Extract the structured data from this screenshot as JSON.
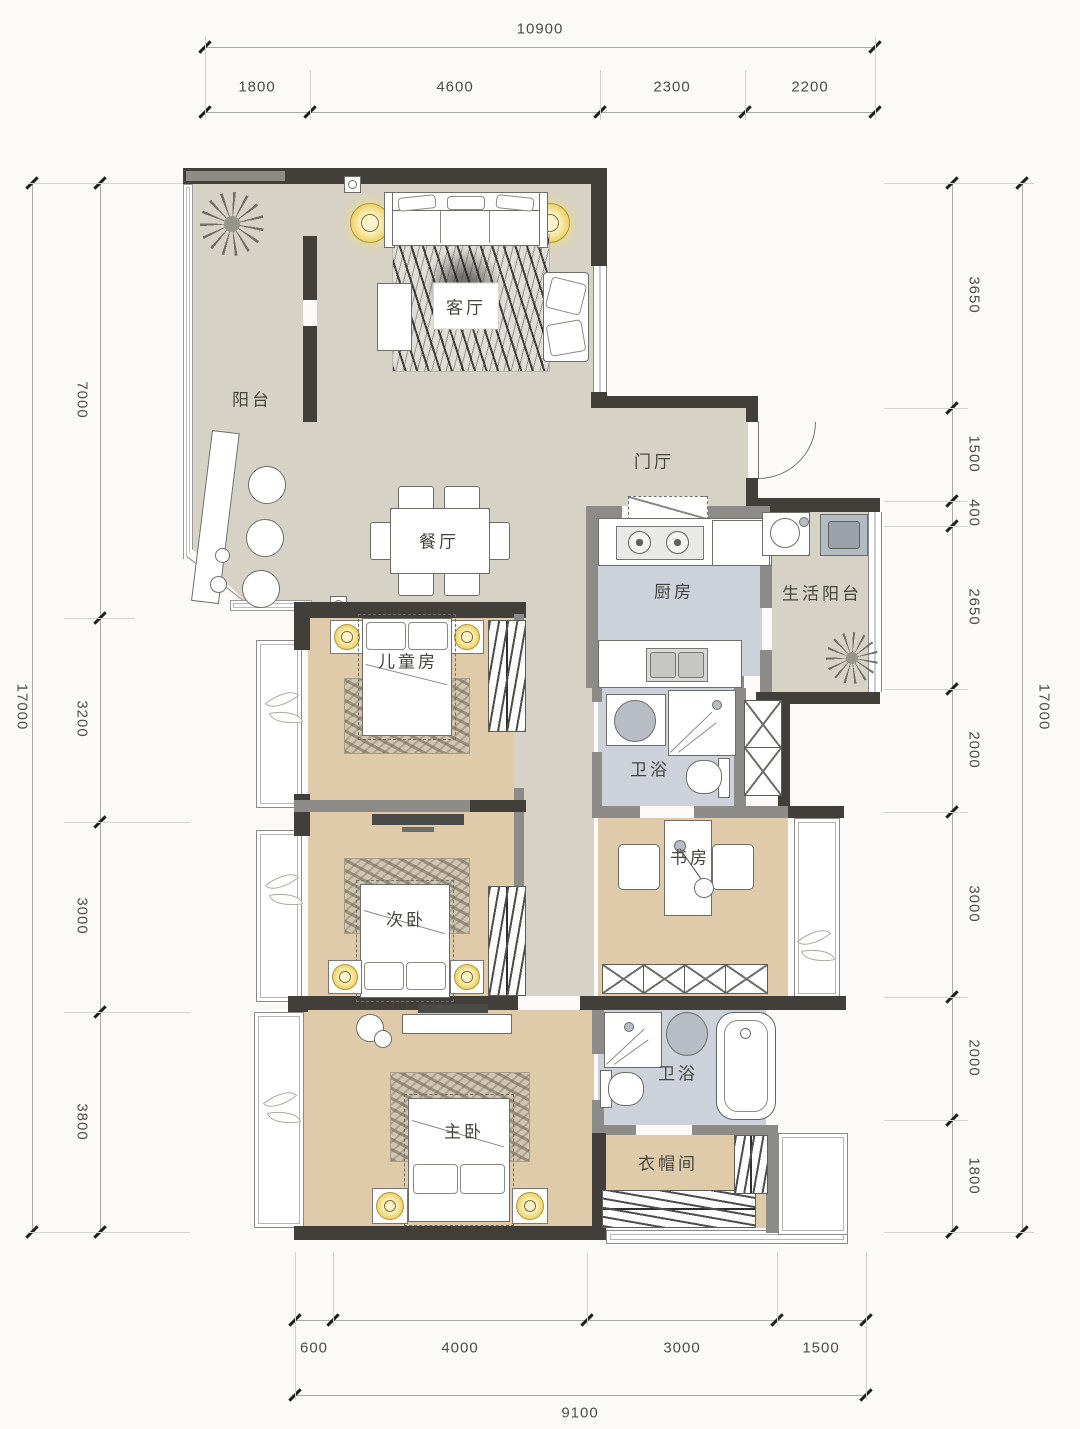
{
  "rooms": {
    "balcony": "阳台",
    "living": "客厅",
    "foyer": "门厅",
    "dining": "餐厅",
    "kitchen": "厨房",
    "service_balcony": "生活阳台",
    "children": "儿童房",
    "bath1": "卫浴",
    "study": "书房",
    "secondary": "次卧",
    "master": "主卧",
    "bath2": "卫浴",
    "closet": "衣帽间"
  },
  "dims": {
    "top": {
      "total": "10900",
      "segments": [
        "1800",
        "4600",
        "2300",
        "2200"
      ]
    },
    "bottom": {
      "total": "9100",
      "segments": [
        "600",
        "4000",
        "3000",
        "1500"
      ]
    },
    "left": {
      "total": "17000",
      "segments": [
        "7000",
        "3200",
        "3000",
        "3800"
      ]
    },
    "right": {
      "total": "17000",
      "segments": [
        "3650",
        "1500",
        "400",
        "2650",
        "2000",
        "3000",
        "2000",
        "1800"
      ]
    }
  },
  "colors": {
    "wall_dark": "#423e3a",
    "wall_mid": "#8d8b88",
    "floor_main": "#d7d2c6",
    "floor_bedroom": "#dfcaaa",
    "floor_wet": "#ccd1da",
    "lamp_yellow": "#f1d977",
    "background": "#fbfaf8"
  }
}
